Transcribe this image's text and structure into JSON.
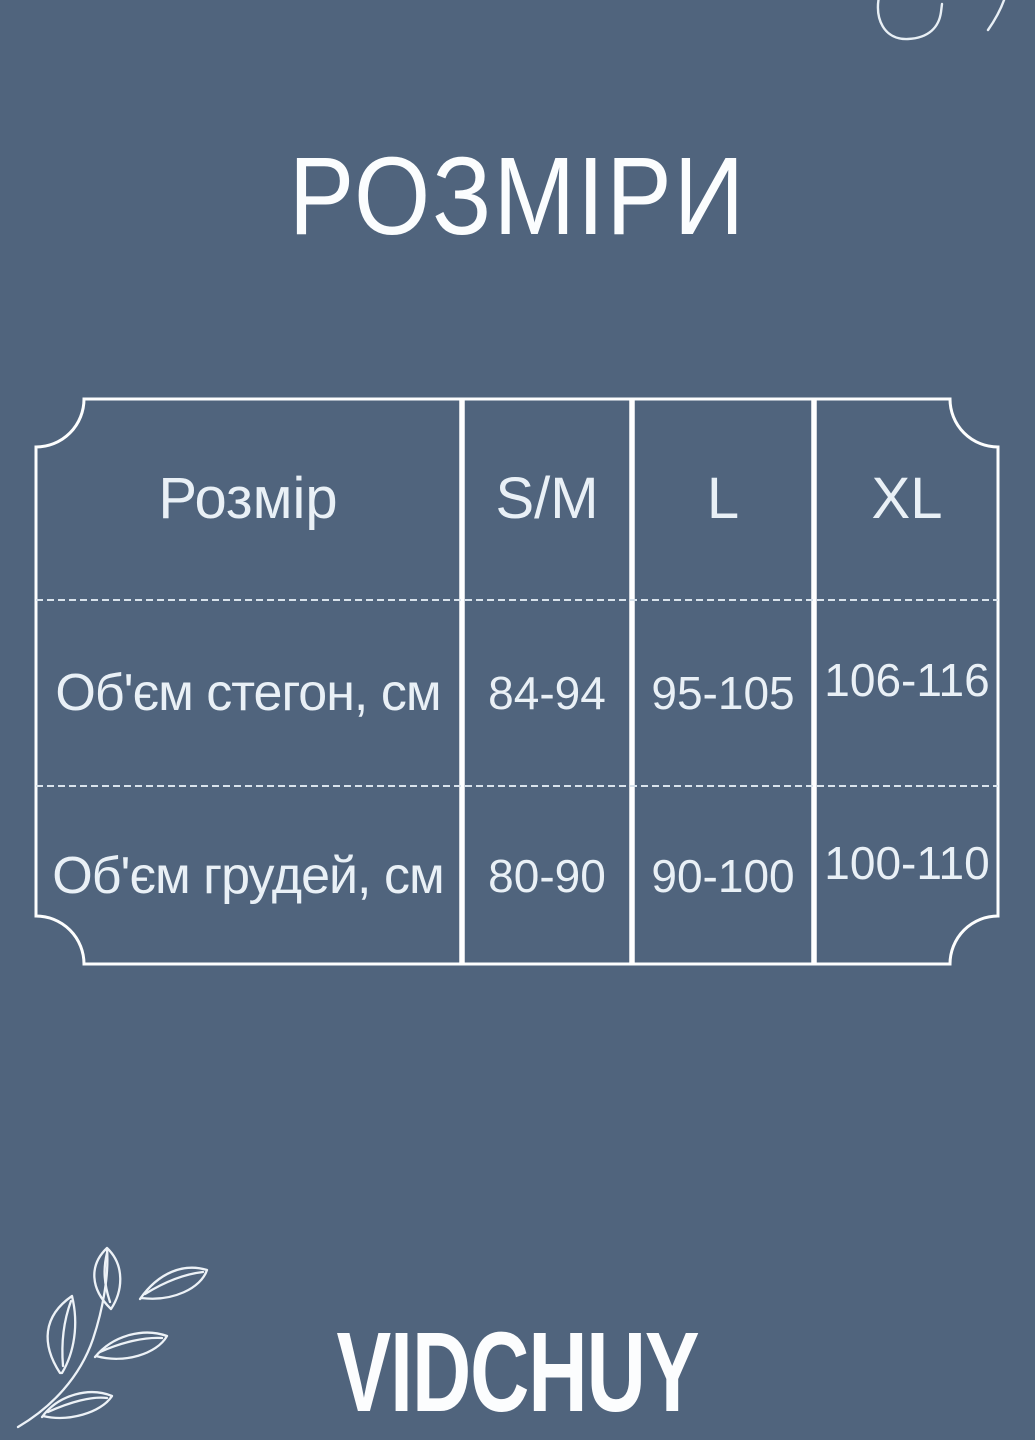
{
  "title": "РОЗМІРИ",
  "brand": "VIDCHUY",
  "colors": {
    "background": "#50647d",
    "table_lines": "#ffffff",
    "dashed_lines": "#d9e3ec",
    "text": "#e9f0f6",
    "title_text": "#fbfdfe"
  },
  "icons": {
    "bottom_left": "leaf-branch-line-art",
    "top_right": "cropped-curve-motif"
  },
  "chart_data": {
    "type": "table",
    "title": "РОЗМІРИ",
    "columns": [
      "Розмір",
      "S/M",
      "L",
      "XL"
    ],
    "rows": [
      [
        "Об'єм стегон, см",
        "84-94",
        "95-105",
        "106-116"
      ],
      [
        "Об'єм грудей, см",
        "80-90",
        "90-100",
        "100-110"
      ]
    ],
    "layout_hints": {
      "frame": "white outline with concave scalloped corners",
      "column_separators": "solid white vertical lines",
      "row_separators": "thin white dashed horizontal lines"
    }
  }
}
